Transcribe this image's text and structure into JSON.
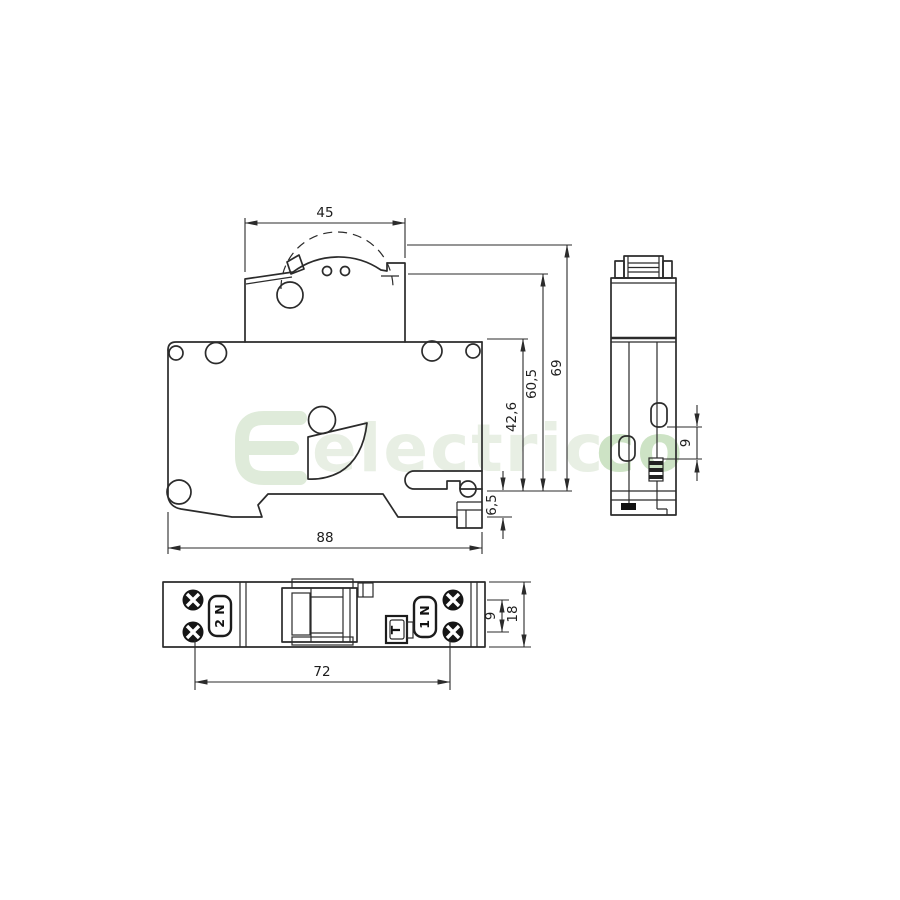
{
  "watermark": {
    "logo_letter": "E",
    "text": "electric",
    "text_highlight": "co",
    "color_light": "#e8efe4",
    "color_highlight": "#cde3c5",
    "color_logo": "#dfebda"
  },
  "front_view": {
    "dim_top_width": "45",
    "dim_overall_width": "88",
    "dim_height_total": "69",
    "dim_height_upper": "60,5",
    "dim_height_body": "42,6",
    "dim_din_clip": "6,5"
  },
  "side_view": {
    "dim_latch": "9"
  },
  "bottom_view": {
    "dim_screw_spacing": "72",
    "dim_terminal_pitch": "9",
    "dim_module_width": "18",
    "terminal_left": "2 N",
    "terminal_right": "1 N",
    "test_button": "T"
  }
}
